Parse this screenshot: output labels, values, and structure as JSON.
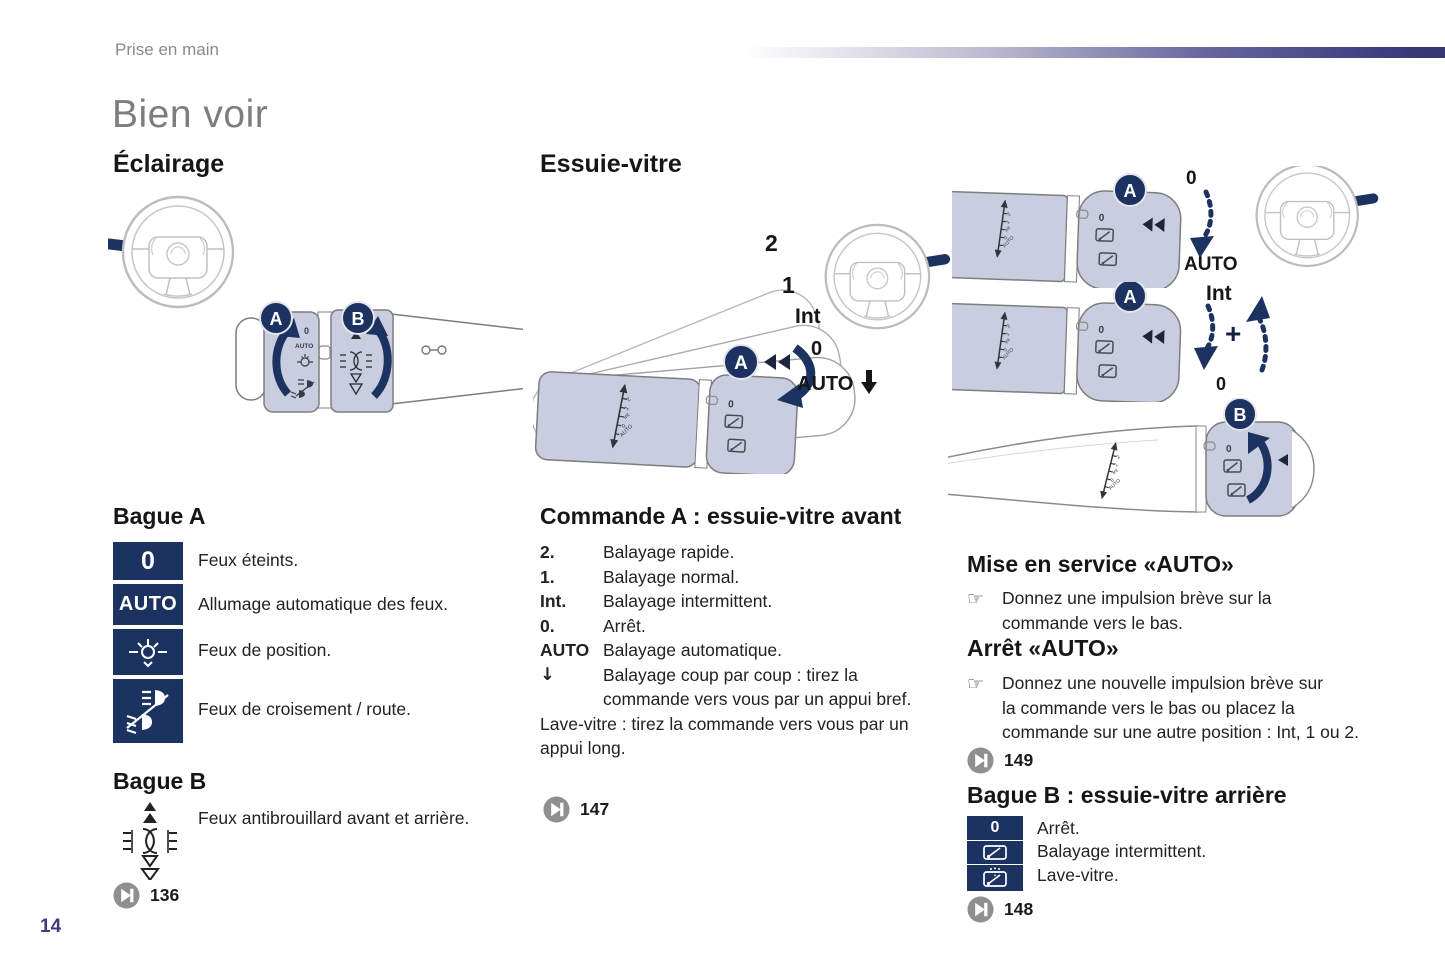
{
  "page": {
    "breadcrumb": "Prise en main",
    "title": "Bien voir",
    "page_number": "14",
    "colors": {
      "navy": "#1c3361",
      "indigo": "#3b3b80",
      "stalk_fill": "#c9cde0",
      "title_gray": "#7d7d7d",
      "ref_gray": "#8f8f8f"
    }
  },
  "lighting": {
    "heading": "Éclairage",
    "ring_a": {
      "heading": "Bague A",
      "items": [
        {
          "icon": "lights-off-icon",
          "symbol": "0",
          "text": "Feux éteints."
        },
        {
          "icon": "auto-lights-icon",
          "symbol": "AUTO",
          "text": "Allumage automatique des feux."
        },
        {
          "icon": "position-lights-icon",
          "text": "Feux de position."
        },
        {
          "icon": "low-high-beam-icon",
          "text": "Feux de croisement / route."
        }
      ]
    },
    "ring_b": {
      "heading": "Bague B",
      "text": "Feux antibrouillard avant et arrière.",
      "page_ref": "136"
    }
  },
  "wiper": {
    "heading": "Essuie-vitre",
    "command_a": {
      "heading": "Commande A : essuie-vitre avant",
      "items": [
        {
          "term": "2.",
          "text": "Balayage rapide."
        },
        {
          "term": "1.",
          "text": "Balayage normal."
        },
        {
          "term": "Int.",
          "text": "Balayage intermittent."
        },
        {
          "term": "0.",
          "text": "Arrêt."
        },
        {
          "term": "AUTO",
          "text": "Balayage automatique."
        },
        {
          "term": "↓",
          "text": "Balayage coup par coup : tirez la\ncommande vers vous par un appui bref."
        }
      ],
      "note": "Lave-vitre : tirez la commande vers vous par un\nappui long.",
      "page_ref": "147"
    },
    "auto_on": {
      "heading": "Mise en service «AUTO»",
      "bullet": "☞",
      "text": "Donnez une impulsion brève sur la\ncommande vers le bas."
    },
    "auto_off": {
      "heading": "Arrêt «AUTO»",
      "bullet": "☞",
      "text": "Donnez une nouvelle impulsion brève sur\nla commande vers le bas ou placez la\ncommande sur une autre position : Int, 1 ou 2.",
      "page_ref": "149"
    },
    "ring_b": {
      "heading": "Bague B : essuie-vitre arrière",
      "items": [
        {
          "icon": "rear-wiper-off-icon",
          "symbol": "0",
          "text": "Arrêt."
        },
        {
          "icon": "rear-wiper-intermittent-icon",
          "text": "Balayage intermittent."
        },
        {
          "icon": "rear-washer-icon",
          "text": "Lave-vitre."
        }
      ],
      "page_ref": "148"
    }
  },
  "figures": {
    "badge_a": "A",
    "badge_b": "B",
    "scale_labels": [
      "2",
      "1",
      "Int",
      "0",
      "AUTO"
    ],
    "positions": [
      "2",
      "1",
      "Int",
      "0",
      "AUTO"
    ],
    "light_ring": {
      "zero": "0",
      "auto": "AUTO"
    },
    "mini_zero": "0",
    "fig_auto_on": {
      "zero": "0",
      "auto": "AUTO"
    },
    "fig_auto_off": {
      "int": "Int",
      "plus": "+",
      "zero": "0"
    }
  }
}
